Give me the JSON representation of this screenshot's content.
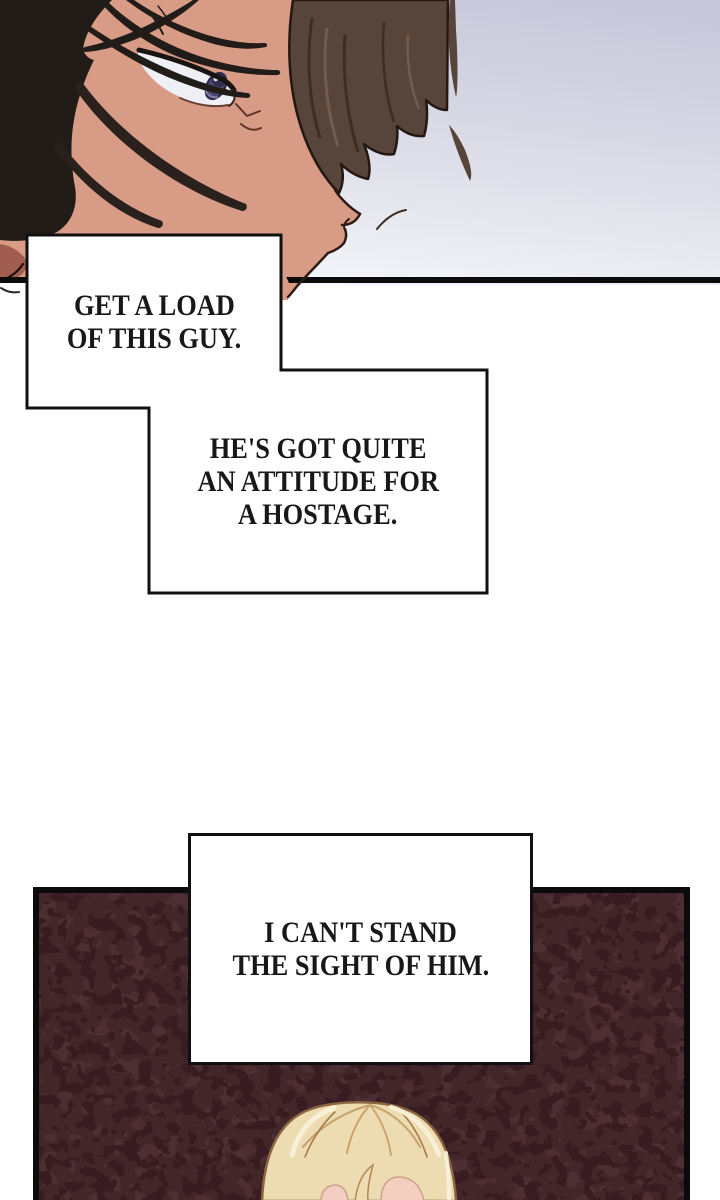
{
  "bubbles": {
    "b1": {
      "lines": [
        "GET A LOAD",
        "OF THIS GUY."
      ]
    },
    "b2": {
      "lines": [
        "HE'S GOT QUITE",
        "AN ATTITUDE FOR",
        "A HOSTAGE."
      ]
    },
    "b3": {
      "lines": [
        "I CAN'T STAND",
        "THE SIGHT OF HIM."
      ]
    }
  },
  "colors": {
    "ink": "#101010",
    "background_top": "#c7c8da",
    "background_mid": "#dddee8",
    "background_bottom": "#f4f5f9",
    "skin": "#d89b85",
    "skin_shadow": "#a05d50",
    "dark_hair": "#221c19",
    "side_hair": "#57443a",
    "sclera": "#eef0f6",
    "iris": "#4b4770",
    "panel_base": "#432629",
    "panel_spot_dark": "#371e22",
    "panel_spot_light": "#4e2d31",
    "blonde_hair": "#eddcb2",
    "blonde_outline": "#8a6540",
    "blonde_skin": "#f2cfc0"
  }
}
